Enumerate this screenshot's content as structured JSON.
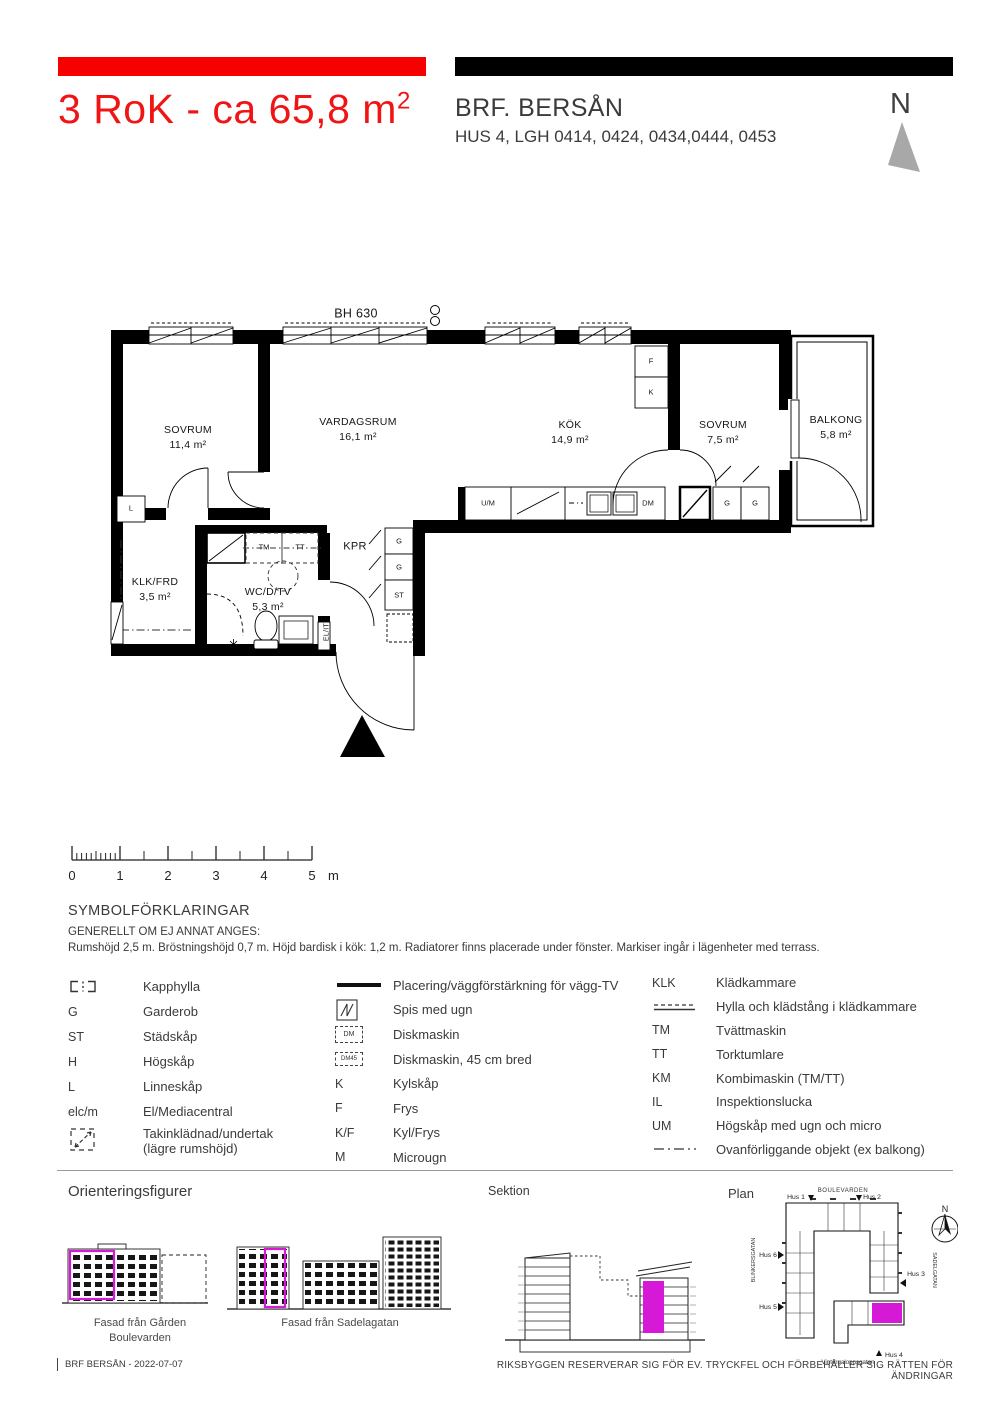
{
  "colors": {
    "accent_red": "#f60000",
    "highlight_magenta": "#d619d6",
    "north_gray": "#a8a8a8"
  },
  "header": {
    "title": "3 RoK - ca 65,8  m",
    "title_sup": "2",
    "project": "BRF. BERSÅN",
    "units": "HUS 4, LGH 0414, 0424, 0434,0444, 0453",
    "north_label": "N"
  },
  "plan": {
    "bh_label": "BH 630",
    "rooms": [
      {
        "name": "SOVRUM",
        "area": "11,4 m²"
      },
      {
        "name": "VARDAGSRUM",
        "area": "16,1 m²"
      },
      {
        "name": "KÖK",
        "area": "14,9 m²"
      },
      {
        "name": "SOVRUM",
        "area": "7,5 m²"
      },
      {
        "name": "BALKONG",
        "area": "5,8 m²"
      },
      {
        "name": "KLK/FRD",
        "area": "3,5 m²"
      },
      {
        "name": "WC/D/TV",
        "area": "5,3 m²"
      },
      {
        "name": "KPR",
        "area": ""
      }
    ],
    "fx": {
      "f": "F",
      "k": "K",
      "um": "U/M",
      "dm": "DM",
      "g": "G",
      "st": "ST",
      "l": "L",
      "tm": "TM",
      "tt": "TT",
      "elit": "EL/IT"
    }
  },
  "scalebar": {
    "labels": [
      "0",
      "1",
      "2",
      "3",
      "4",
      "5"
    ],
    "unit": "m"
  },
  "symbols": {
    "heading": "SYMBOLFÖRKLARINGAR",
    "subheading": "GENERELLT OM EJ ANNAT ANGES:",
    "general": "Rumshöjd 2,5 m. Bröstningshöjd 0,7 m. Höjd bardisk i kök: 1,2 m. Radiatorer finns placerade under fönster. Markiser ingår i lägenheter med terrass.",
    "col1": [
      {
        "code": "",
        "label": "Kapphylla"
      },
      {
        "code": "G",
        "label": "Garderob"
      },
      {
        "code": "ST",
        "label": "Städskåp"
      },
      {
        "code": "H",
        "label": "Högskåp"
      },
      {
        "code": "L",
        "label": "Linneskåp"
      },
      {
        "code": "elc/m",
        "label": "El/Mediacentral"
      },
      {
        "code": "",
        "label": "Takinklädnad/undertak",
        "label2": "(lägre rumshöjd)"
      }
    ],
    "col2": [
      {
        "code": "",
        "label": "Placering/väggförstärkning för vägg-TV"
      },
      {
        "code": "",
        "label": "Spis med ugn"
      },
      {
        "code": "DM",
        "label": "Diskmaskin"
      },
      {
        "code": "DM45",
        "label": "Diskmaskin, 45 cm bred"
      },
      {
        "code": "K",
        "label": "Kylskåp"
      },
      {
        "code": "F",
        "label": "Frys"
      },
      {
        "code": "K/F",
        "label": "Kyl/Frys"
      },
      {
        "code": "M",
        "label": "Microugn"
      }
    ],
    "col3": [
      {
        "code": "KLK",
        "label": "Klädkammare"
      },
      {
        "code": "",
        "label": "Hylla och klädstång i klädkammare"
      },
      {
        "code": "TM",
        "label": "Tvättmaskin"
      },
      {
        "code": "TT",
        "label": "Torktumlare"
      },
      {
        "code": "KM",
        "label": "Kombimaskin (TM/TT)"
      },
      {
        "code": "IL",
        "label": "Inspektionslucka"
      },
      {
        "code": "UM",
        "label": "Högskåp med ugn och micro"
      },
      {
        "code": "",
        "label": "Ovanförliggande objekt (ex  balkong)"
      }
    ]
  },
  "figures": {
    "orientering_heading": "Orienteringsfigurer",
    "facade1_caption_1": "Fasad från Gården",
    "facade1_caption_2": "Boulevarden",
    "facade2_caption": "Fasad från Sadelagatan",
    "sektion_heading": "Sektion",
    "plan_heading": "Plan",
    "site": {
      "street_top": "BOULEVARDEN",
      "street_left": "BLINKERSGATAN",
      "street_right": "SADELGATAN",
      "street_bottom": "Vintergaloppsgatan",
      "hus1": "Hus 1",
      "hus2": "Hus 2",
      "hus3": "Hus 3",
      "hus4": "Hus 4",
      "hus5": "Hus 5",
      "hus6": "Hus 6",
      "north": "N"
    }
  },
  "footer": {
    "left": "BRF BERSÅN  - 2022-07-07",
    "right": "RIKSBYGGEN RESERVERAR SIG FÖR EV. TRYCKFEL OCH FÖRBEHÅLLER SIG RÄTTEN FÖR ÄNDRINGAR"
  }
}
